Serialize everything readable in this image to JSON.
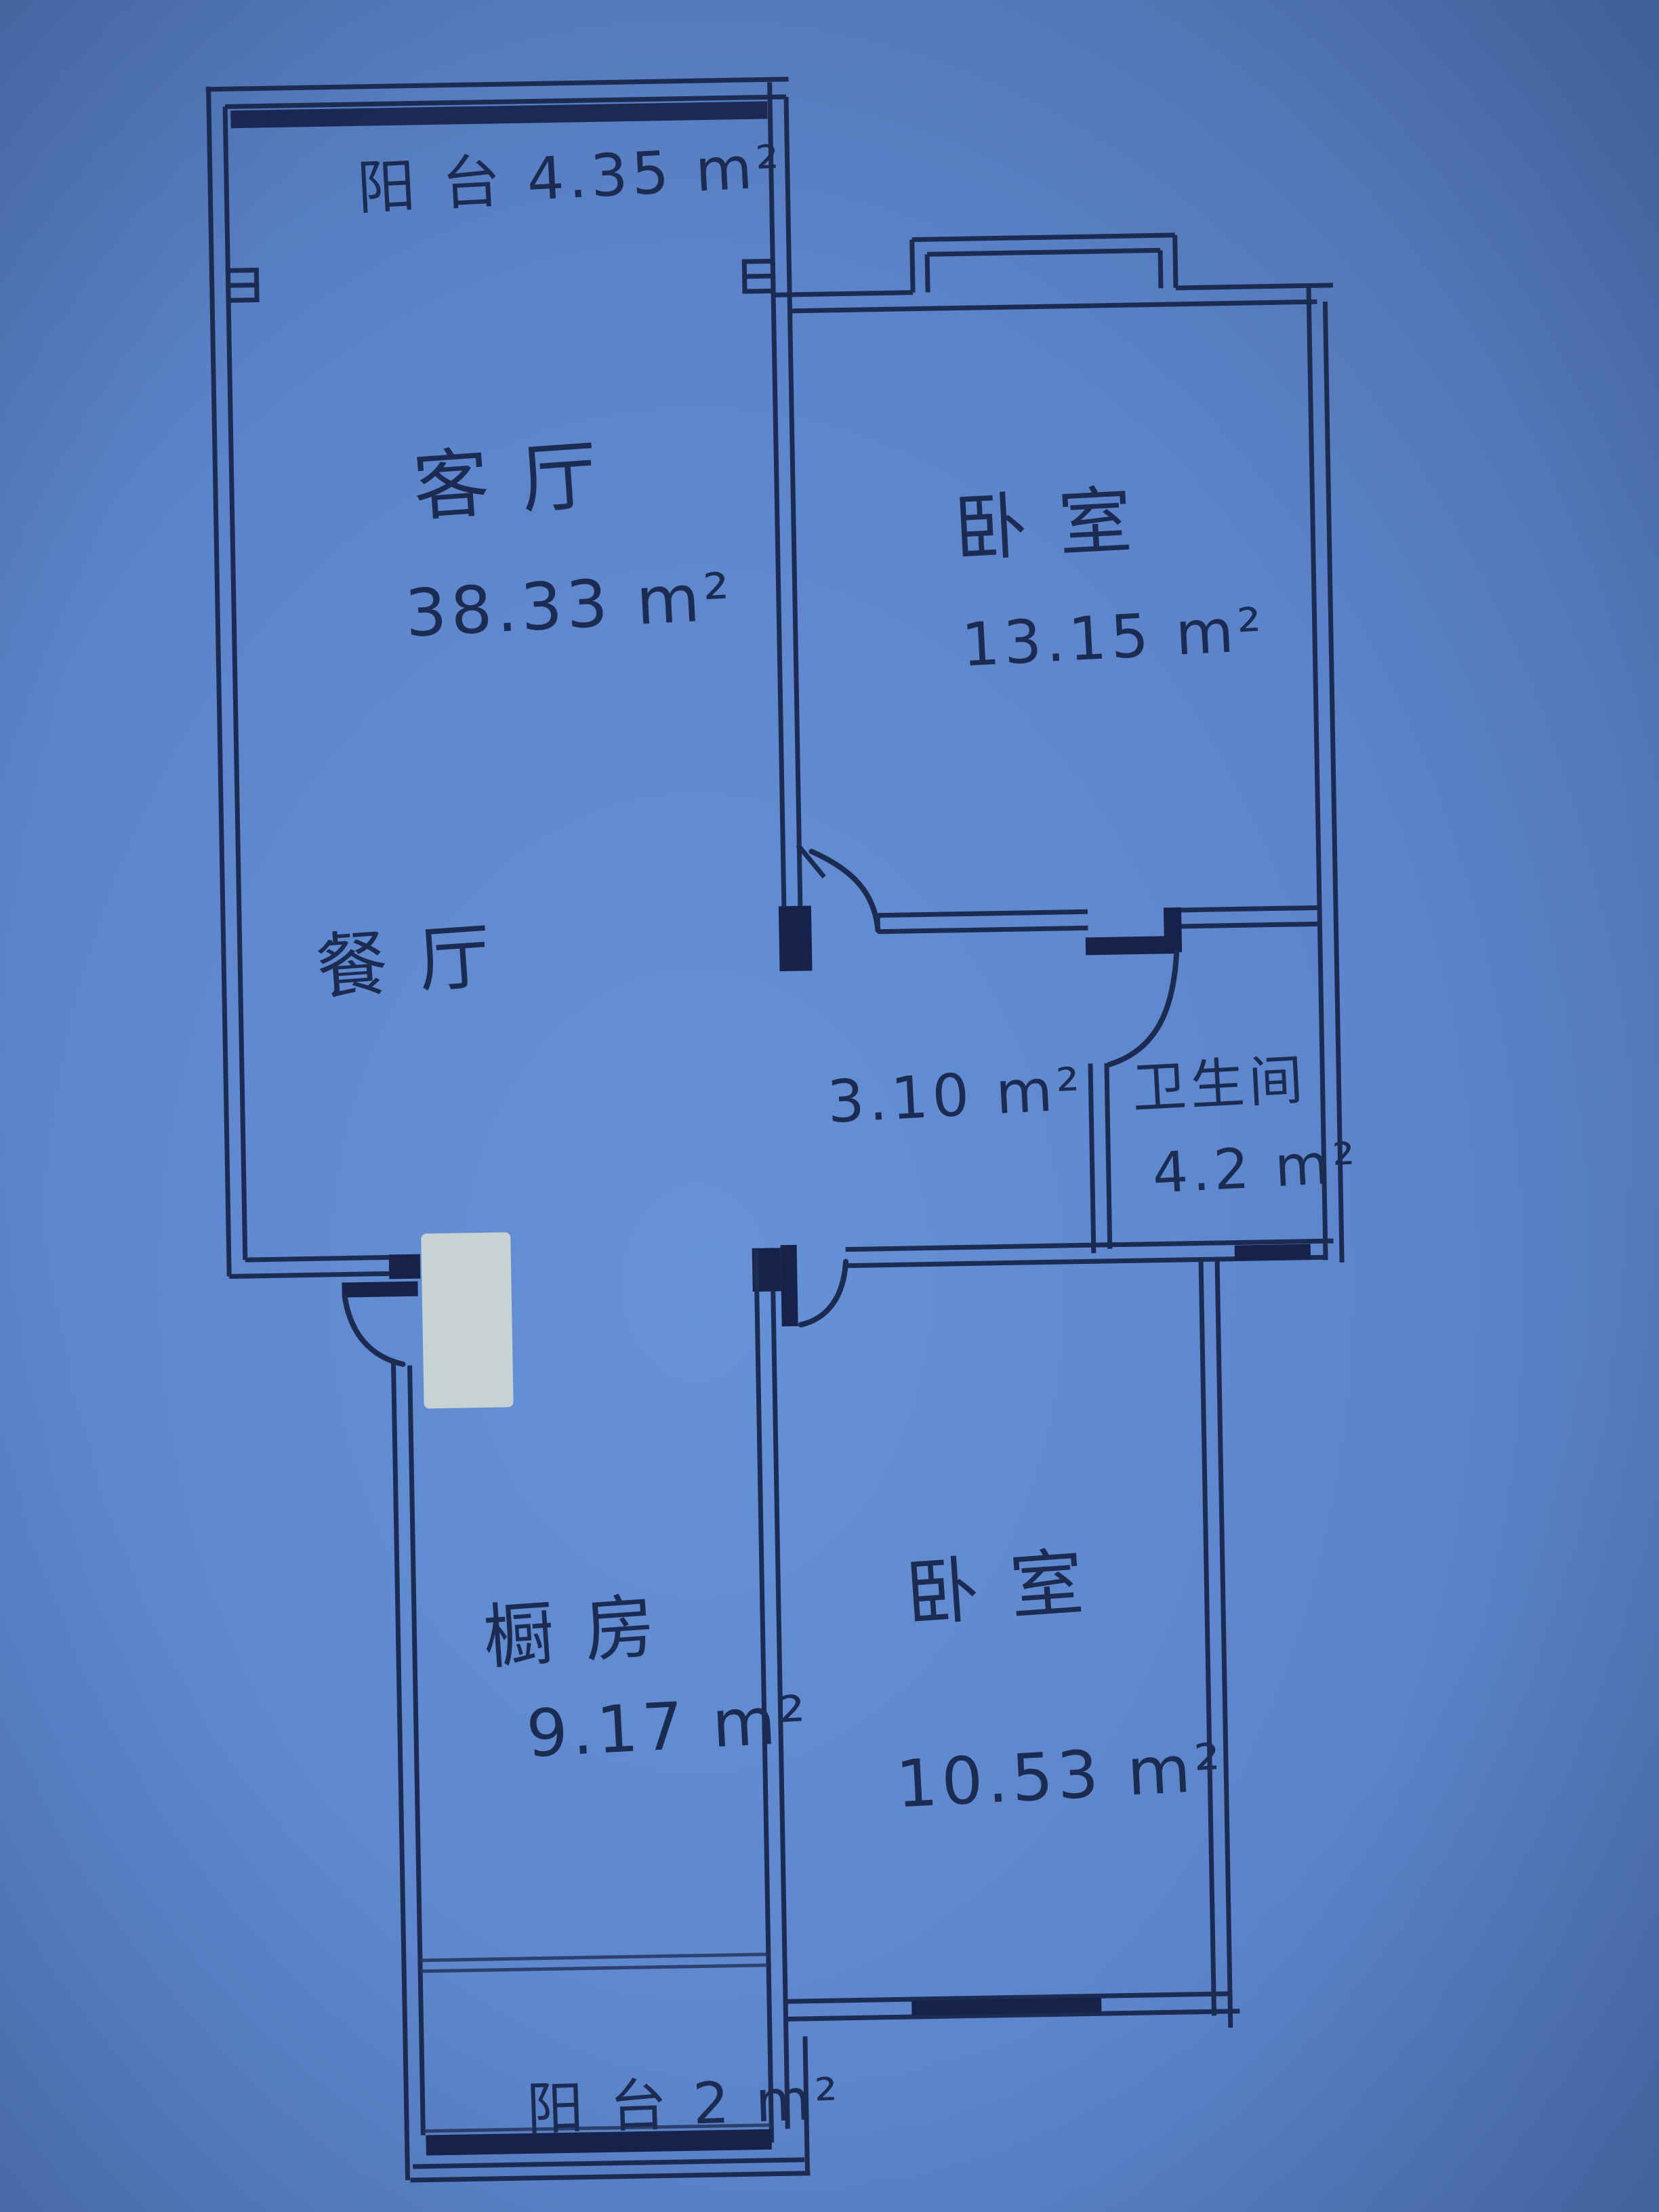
{
  "document": {
    "kind": "hand-drawn apartment floor plan (photo on blue paper)",
    "language": "zh-CN",
    "units": "m²"
  },
  "palette": {
    "paper": "#5b83c9",
    "paper_light": "#6a95da",
    "paper_dark": "#46659f",
    "ink": "#1c2b52",
    "correction_patch": "#cbd7d2"
  },
  "rooms": [
    {
      "id": "balcony-top",
      "label": "阳 台 4.35 m²",
      "area_m2": "4.35"
    },
    {
      "id": "living-room",
      "name_label": "客 厅",
      "area_label": "38.33 m²",
      "area_m2": "38.33"
    },
    {
      "id": "bedroom-north",
      "name_label": "卧 室",
      "area_label": "13.15 m²",
      "area_m2": "13.15"
    },
    {
      "id": "dining-room",
      "name_label": "餐 厅"
    },
    {
      "id": "hallway",
      "area_label": "3.10 m²",
      "area_m2": "3.10"
    },
    {
      "id": "bathroom",
      "name_label": "卫生间",
      "area_label": "4.2 m²",
      "area_m2": "4.2"
    },
    {
      "id": "kitchen",
      "name_label": "橱 房",
      "area_label": "9.17 m²",
      "area_m2": "9.17"
    },
    {
      "id": "bedroom-south",
      "name_label": "卧 室",
      "area_label": "10.53 m²",
      "area_m2": "10.53"
    },
    {
      "id": "balcony-bottom",
      "label": "阳 台 2 m²",
      "area_m2": "2"
    }
  ],
  "plan_features": {
    "walls": "double-line hand-inked walls",
    "windows": [
      "balcony-top-window-band",
      "bedroom-north-bay-window-bump",
      "bathroom-bottom-window-band",
      "bedroom-south-window-band",
      "balcony-bottom-window-band"
    ],
    "doors": [
      "entrance-door-arc (dining room, bottom-left)",
      "bedroom-north-door-arc (from hallway)",
      "bathroom-door-arc",
      "bedroom-south-door-arc (beside kitchen wall)"
    ],
    "other": [
      "white correction-fluid patch near entrance door",
      "small wall tick marks between top balcony and living room"
    ]
  }
}
